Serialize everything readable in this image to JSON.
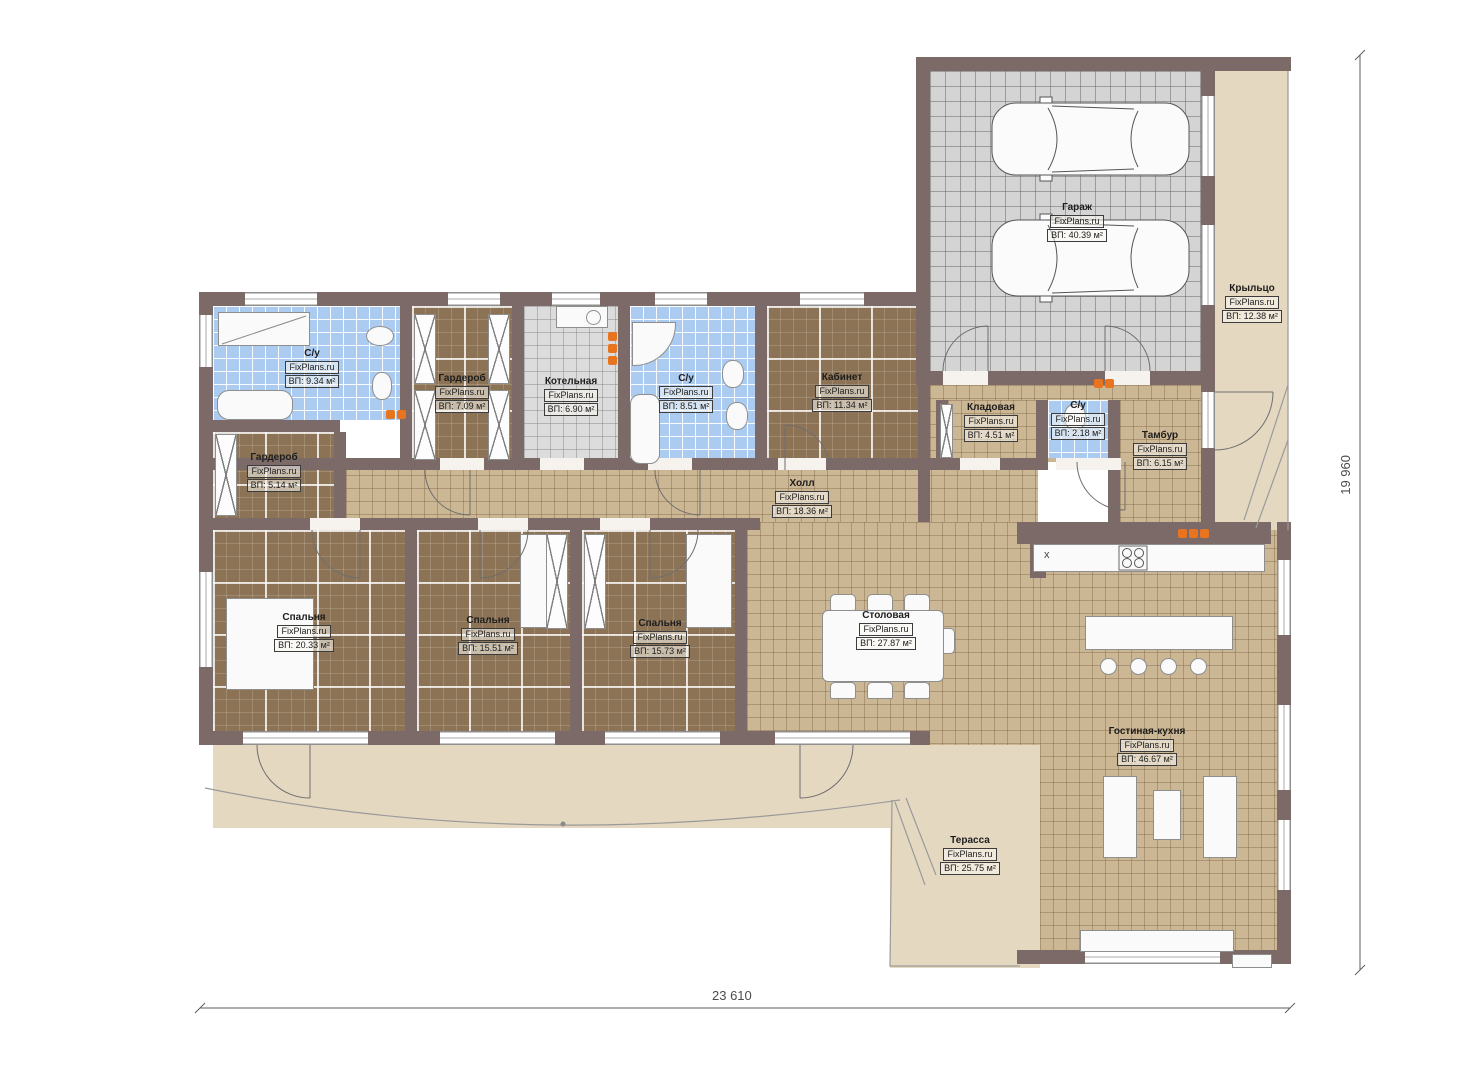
{
  "watermark": "FixPlans.ru",
  "dimensions": {
    "bottom": "23 610",
    "right": "19 960"
  },
  "symbols": {
    "sink": "x"
  },
  "colors": {
    "wall": "#7c6a69",
    "floor_wood": "#8d7355",
    "floor_tile_tan": "#ccb795",
    "floor_tile_blue": "#abcbf0",
    "floor_tile_grey": "#d4d4d4",
    "terrace": "#e5d8c1",
    "radiator": "#e87420"
  },
  "rooms": [
    {
      "id": "su1",
      "name": "С/у",
      "area": "ВП: 9.34 м²"
    },
    {
      "id": "garderob1",
      "name": "Гардероб",
      "area": "ВП: 7.09 м²"
    },
    {
      "id": "kotelnaya",
      "name": "Котельная",
      "area": "ВП: 6.90 м²"
    },
    {
      "id": "su2",
      "name": "С/у",
      "area": "ВП: 8.51 м²"
    },
    {
      "id": "kabinet",
      "name": "Кабинет",
      "area": "ВП: 11.34 м²"
    },
    {
      "id": "kladovaya",
      "name": "Кладовая",
      "area": "ВП: 4.51 м²"
    },
    {
      "id": "su3",
      "name": "С/у",
      "area": "ВП: 2.18 м²"
    },
    {
      "id": "tambur",
      "name": "Тамбур",
      "area": "ВП: 6.15 м²"
    },
    {
      "id": "garderob2",
      "name": "Гардероб",
      "area": "ВП: 5.14 м²"
    },
    {
      "id": "holl",
      "name": "Холл",
      "area": "ВП: 18.36 м²"
    },
    {
      "id": "bedroom1",
      "name": "Спальня",
      "area": "ВП: 20.33 м²"
    },
    {
      "id": "bedroom2",
      "name": "Спальня",
      "area": "ВП: 15.51 м²"
    },
    {
      "id": "bedroom3",
      "name": "Спальня",
      "area": "ВП: 15.73 м²"
    },
    {
      "id": "stolovaya",
      "name": "Столовая",
      "area": "ВП: 27.87 м²"
    },
    {
      "id": "gostinaya",
      "name": "Гостиная-кухня",
      "area": "ВП: 46.67 м²"
    },
    {
      "id": "garage",
      "name": "Гараж",
      "area": "ВП: 40.39 м²"
    },
    {
      "id": "kryltso",
      "name": "Крыльцо",
      "area": "ВП: 12.38 м²"
    },
    {
      "id": "terrassa",
      "name": "Терасса",
      "area": "ВП: 25.75 м²"
    }
  ]
}
